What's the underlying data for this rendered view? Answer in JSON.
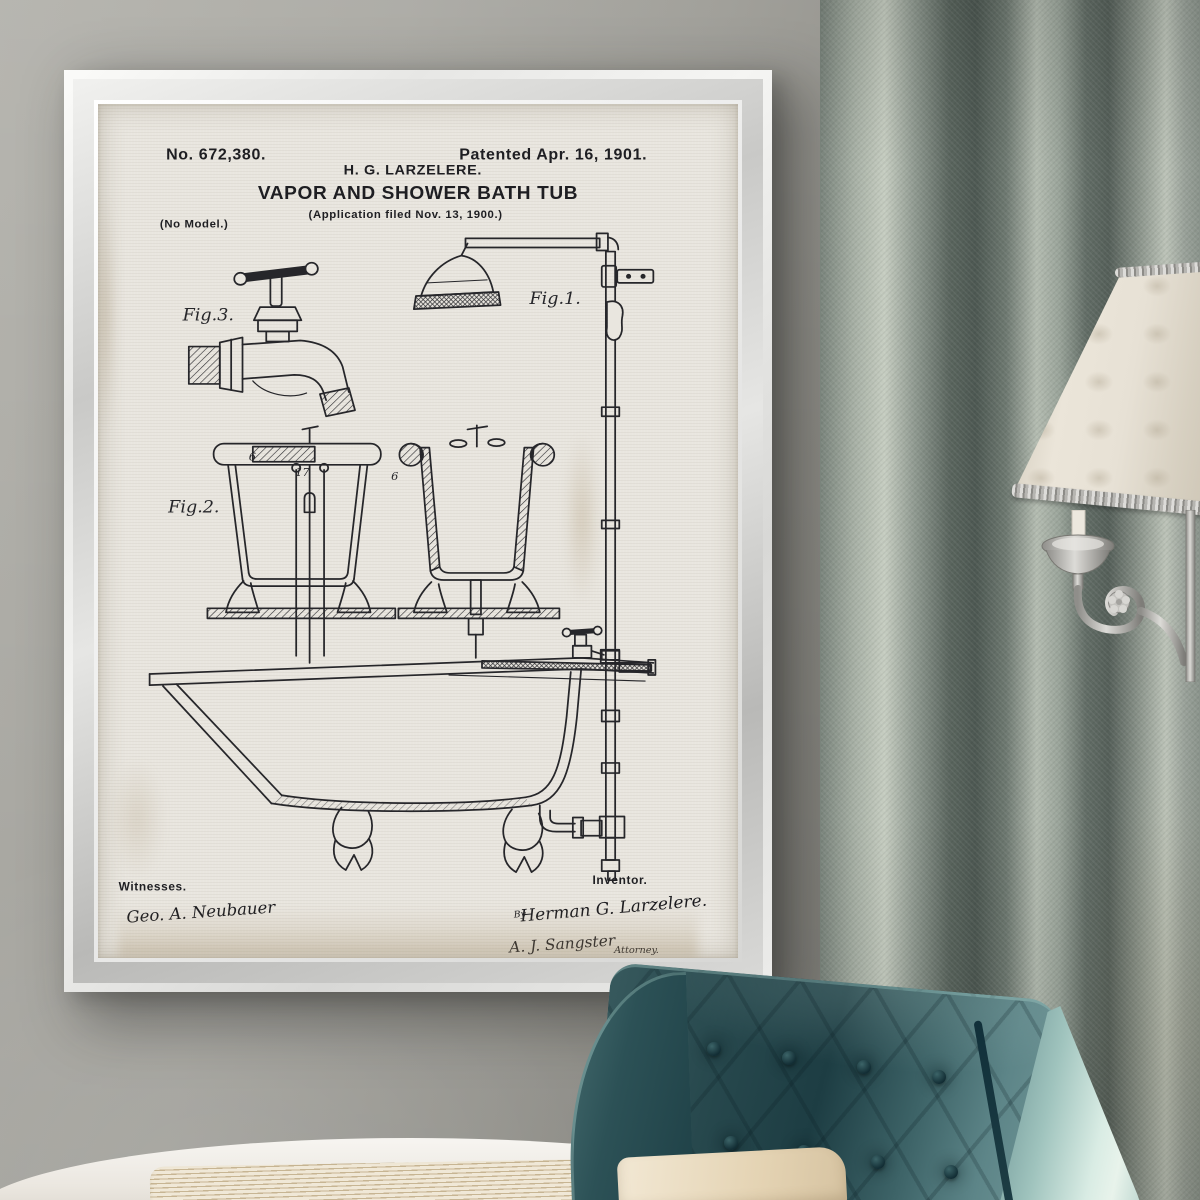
{
  "artwork": {
    "header": {
      "patent_number": "No. 672,380.",
      "patent_date": "Patented Apr. 16, 1901.",
      "inventor_line": "H. G. LARZELERE.",
      "title": "VAPOR AND SHOWER BATH TUB",
      "application_line": "(Application filed Nov. 13, 1900.)",
      "no_model": "(No Model.)"
    },
    "figures": {
      "fig1": "Fig.1.",
      "fig2": "Fig.2.",
      "fig3": "Fig.3.",
      "ref_left_rim": "6",
      "ref_pipes": "17",
      "ref_right_rim": "6"
    },
    "footer": {
      "witnesses_label": "Witnesses.",
      "witness_signature": "Geo. A. Neubauer",
      "inventor_label": "Inventor.",
      "by_prefix": "By",
      "inventor_signature": "Herman G. Larzelere.",
      "attorney_signature": "A. J. Sangster",
      "attorney_label": "Attorney."
    }
  },
  "colors": {
    "wall": "#9b9a94",
    "frame_silver": "#e6e6e4",
    "paper": "#e9e6df",
    "ink": "#26262a",
    "curtain": "#8a948c",
    "curtain_shadow": "#4d5852",
    "chair_teal_dark": "#1e3e44",
    "chair_teal_light": "#74999a",
    "chair_side_mint": "#d9ece4",
    "lamp_shade": "#e2dcd0",
    "lamp_metal": "#b5b4b0",
    "pillow": "#e9dcbf",
    "bed_white": "#f4f2ee"
  }
}
